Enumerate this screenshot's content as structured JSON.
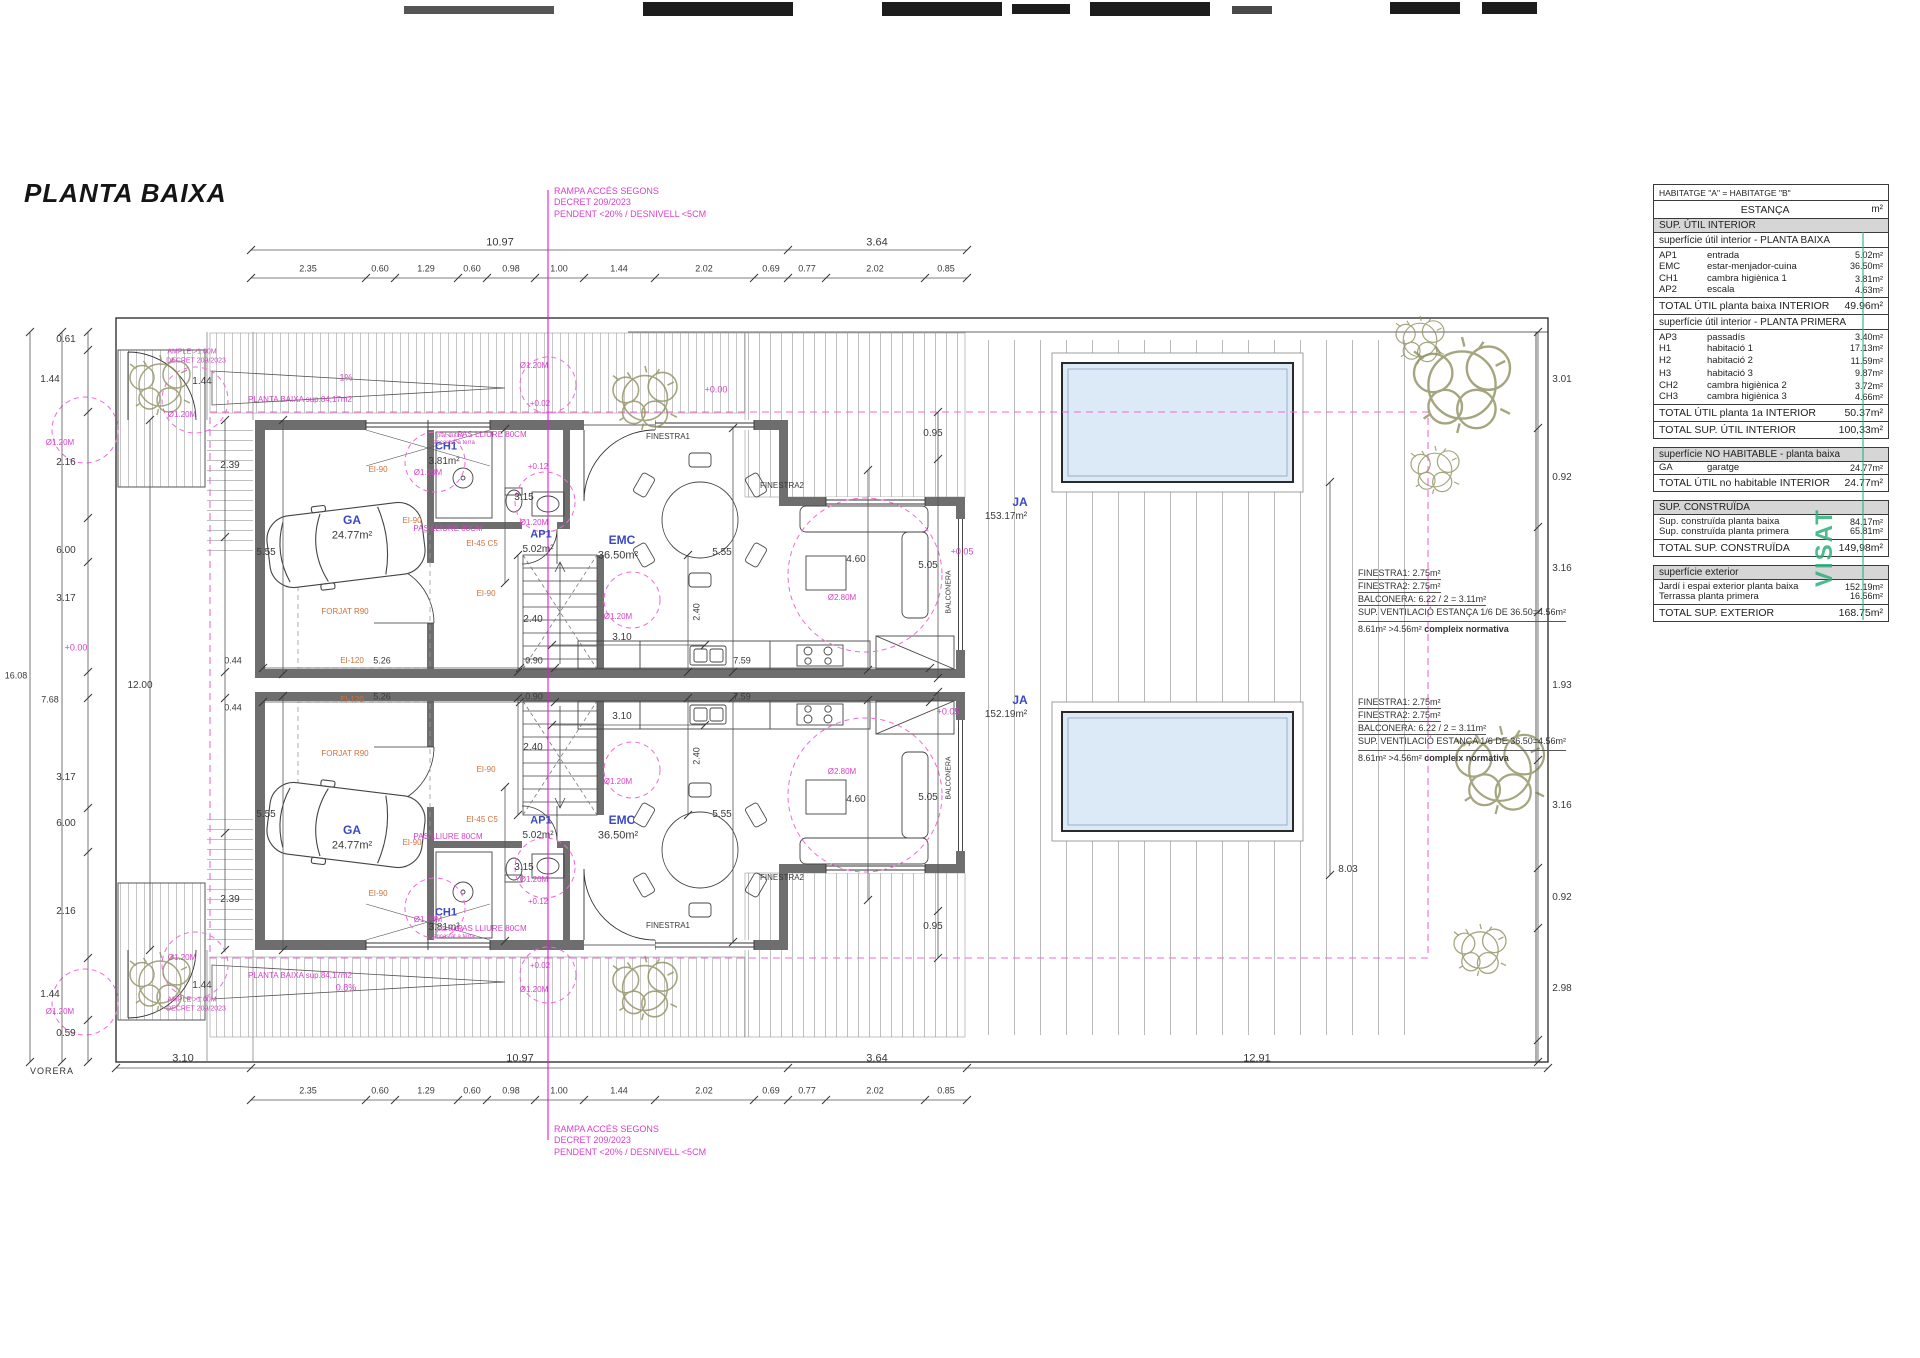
{
  "title": "PLANTA BAIXA",
  "street_label": "VORERA",
  "stamp": {
    "visat": "VISAT"
  },
  "colors": {
    "pink": "#d93fca",
    "orange": "#d2703a",
    "blue": "#3b49c1",
    "pool": "#dce9f6",
    "wall": "#6e6e6e",
    "stamp_green": "#2fae7d"
  },
  "ramp_note": [
    "RAMPA ACCÉS SEGONS",
    "DECRET 209/2023",
    "PENDENT <20% / DESNIVELL <5CM"
  ],
  "vent_note": {
    "lines": [
      "FINESTRA1:  2.75m²",
      "FINESTRA2:  2.75m²",
      "BALCONERA: 6.22 / 2 = 3.11m²"
    ],
    "line4": "SUP. VENTILACIÓ ESTANÇA 1/6 DE 36.50=4.56m²",
    "result": "8.61m² >4.56m² ",
    "result_bold": "compleix normativa"
  },
  "plan_labels": [
    [
      "10.97",
      500,
      243,
      "k",
      11
    ],
    [
      "3.64",
      877,
      243,
      "k",
      11
    ],
    [
      "2.35",
      308,
      269,
      "k",
      9
    ],
    [
      "0.60",
      380,
      269,
      "k",
      9
    ],
    [
      "1.29",
      426,
      269,
      "k",
      9
    ],
    [
      "0.60",
      472,
      269,
      "k",
      9
    ],
    [
      "0.98",
      511,
      269,
      "k",
      9
    ],
    [
      "1.00",
      559,
      269,
      "k",
      9
    ],
    [
      "1.44",
      619,
      269,
      "k",
      9
    ],
    [
      "2.02",
      704,
      269,
      "k",
      9
    ],
    [
      "0.69",
      771,
      269,
      "k",
      9
    ],
    [
      "0.77",
      807,
      269,
      "k",
      9
    ],
    [
      "2.02",
      875,
      269,
      "k",
      9
    ],
    [
      "0.85",
      946,
      269,
      "k",
      9
    ],
    [
      "3.10",
      183,
      1059,
      "k",
      11
    ],
    [
      "10.97",
      520,
      1059,
      "k",
      11
    ],
    [
      "3.64",
      877,
      1059,
      "k",
      11
    ],
    [
      "12.91",
      1257,
      1059,
      "k",
      11
    ],
    [
      "2.35",
      308,
      1091,
      "k",
      9
    ],
    [
      "0.60",
      380,
      1091,
      "k",
      9
    ],
    [
      "1.29",
      426,
      1091,
      "k",
      9
    ],
    [
      "0.60",
      472,
      1091,
      "k",
      9
    ],
    [
      "0.98",
      511,
      1091,
      "k",
      9
    ],
    [
      "1.00",
      559,
      1091,
      "k",
      9
    ],
    [
      "1.44",
      619,
      1091,
      "k",
      9
    ],
    [
      "2.02",
      704,
      1091,
      "k",
      9
    ],
    [
      "0.69",
      771,
      1091,
      "k",
      9
    ],
    [
      "0.77",
      807,
      1091,
      "k",
      9
    ],
    [
      "2.02",
      875,
      1091,
      "k",
      9
    ],
    [
      "0.85",
      946,
      1091,
      "k",
      9
    ],
    [
      "0.61",
      66,
      340,
      "k",
      10
    ],
    [
      "1.44",
      50,
      380,
      "k",
      10
    ],
    [
      "2.16",
      66,
      463,
      "k",
      10
    ],
    [
      "6.00",
      66,
      551,
      "k",
      10
    ],
    [
      "3.17",
      66,
      599,
      "k",
      10
    ],
    [
      "3.17",
      66,
      778,
      "k",
      10
    ],
    [
      "6.00",
      66,
      824,
      "k",
      10
    ],
    [
      "2.16",
      66,
      912,
      "k",
      10
    ],
    [
      "1.44",
      50,
      995,
      "k",
      10
    ],
    [
      "0.59",
      66,
      1034,
      "k",
      10
    ],
    [
      "16.08",
      16,
      676,
      "k",
      9
    ],
    [
      "7.68",
      50,
      700,
      "k",
      9
    ],
    [
      "12.00",
      140,
      686,
      "k",
      10
    ],
    [
      "0.44",
      233,
      661,
      "k",
      9
    ],
    [
      "0.44",
      233,
      708,
      "k",
      9
    ],
    [
      "+0.00",
      76,
      648,
      "p",
      9
    ],
    [
      "3.01",
      1562,
      380,
      "k",
      10
    ],
    [
      "0.92",
      1562,
      478,
      "k",
      10
    ],
    [
      "3.16",
      1562,
      569,
      "k",
      10
    ],
    [
      "1.93",
      1562,
      686,
      "k",
      10
    ],
    [
      "3.16",
      1562,
      806,
      "k",
      10
    ],
    [
      "0.92",
      1562,
      898,
      "k",
      10
    ],
    [
      "2.98",
      1562,
      989,
      "k",
      10
    ],
    [
      "8.03",
      1348,
      870,
      "k",
      10
    ],
    [
      "5.55",
      266,
      553,
      "k",
      10
    ],
    [
      "5.55",
      266,
      815,
      "k",
      10
    ],
    [
      "5.55",
      722,
      553,
      "k",
      10
    ],
    [
      "5.55",
      722,
      815,
      "k",
      10
    ],
    [
      "2.39",
      230,
      466,
      "k",
      10
    ],
    [
      "2.39",
      230,
      900,
      "k",
      10
    ],
    [
      "3.15",
      524,
      498,
      "k",
      10
    ],
    [
      "3.15",
      524,
      868,
      "k",
      10
    ],
    [
      "2.40",
      533,
      620,
      "k",
      10
    ],
    [
      "2.40",
      533,
      748,
      "k",
      10
    ],
    [
      "2.40",
      697,
      612,
      "k",
      9,
      1
    ],
    [
      "2.40",
      697,
      756,
      "k",
      9,
      1
    ],
    [
      "3.10",
      622,
      638,
      "k",
      10
    ],
    [
      "3.10",
      622,
      717,
      "k",
      10
    ],
    [
      "0.90",
      534,
      661,
      "k",
      9
    ],
    [
      "0.90",
      534,
      697,
      "k",
      9
    ],
    [
      "5.26",
      382,
      661,
      "k",
      9
    ],
    [
      "5.26",
      382,
      697,
      "k",
      9
    ],
    [
      "7.59",
      742,
      661,
      "k",
      9
    ],
    [
      "7.59",
      742,
      697,
      "k",
      9
    ],
    [
      "0.95",
      933,
      434,
      "k",
      10
    ],
    [
      "0.95",
      933,
      927,
      "k",
      10
    ],
    [
      "5.05",
      928,
      566,
      "k",
      10
    ],
    [
      "5.05",
      928,
      798,
      "k",
      10
    ],
    [
      "4.60",
      856,
      560,
      "k",
      10
    ],
    [
      "4.60",
      856,
      800,
      "k",
      10
    ],
    [
      "FINESTRA1",
      668,
      437,
      "k",
      8
    ],
    [
      "FINESTRA1",
      668,
      926,
      "k",
      8
    ],
    [
      "FINESTRA2",
      782,
      486,
      "k",
      8
    ],
    [
      "FINESTRA2",
      782,
      878,
      "k",
      8
    ],
    [
      "BALCONERA",
      949,
      592,
      "k",
      7,
      1
    ],
    [
      "BALCONERA",
      949,
      778,
      "k",
      7,
      1
    ],
    [
      "GA",
      352,
      520,
      "b",
      12
    ],
    [
      "24.77m²",
      352,
      536,
      "k",
      11
    ],
    [
      "GA",
      352,
      830,
      "b",
      12
    ],
    [
      "24.77m²",
      352,
      846,
      "k",
      11
    ],
    [
      "CH1",
      446,
      447,
      "b",
      11
    ],
    [
      "3.81m²",
      444,
      462,
      "k",
      10
    ],
    [
      "CH1",
      446,
      913,
      "b",
      11
    ],
    [
      "3.81m²",
      444,
      928,
      "k",
      10
    ],
    [
      "AP1",
      541,
      535,
      "b",
      11
    ],
    [
      "5.02m²",
      538,
      550,
      "k",
      10
    ],
    [
      "AP1",
      541,
      821,
      "b",
      11
    ],
    [
      "5.02m²",
      538,
      836,
      "k",
      10
    ],
    [
      "EMC",
      622,
      540,
      "b",
      12
    ],
    [
      "36.50m²",
      618,
      556,
      "k",
      11
    ],
    [
      "EMC",
      622,
      820,
      "b",
      12
    ],
    [
      "36.50m²",
      618,
      836,
      "k",
      11
    ],
    [
      "JA",
      1020,
      502,
      "b",
      12
    ],
    [
      "153.17m²",
      1006,
      517,
      "k",
      10
    ],
    [
      "JA",
      1020,
      700,
      "b",
      12
    ],
    [
      "152.19m²",
      1006,
      715,
      "k",
      10
    ],
    [
      "EI-90",
      378,
      470,
      "o",
      8
    ],
    [
      "EI-90",
      412,
      521,
      "o",
      8
    ],
    [
      "EI-90",
      486,
      594,
      "o",
      8
    ],
    [
      "EI-90",
      378,
      894,
      "o",
      8
    ],
    [
      "EI-90",
      412,
      843,
      "o",
      8
    ],
    [
      "EI-90",
      486,
      770,
      "o",
      8
    ],
    [
      "EI-45 C5",
      482,
      544,
      "o",
      8
    ],
    [
      "EI-45 C5",
      482,
      820,
      "o",
      8
    ],
    [
      "EI-120",
      352,
      661,
      "o",
      8
    ],
    [
      "EI-120",
      352,
      700,
      "o",
      8
    ],
    [
      "FORJAT R90",
      345,
      612,
      "o",
      8
    ],
    [
      "FORJAT R90",
      345,
      754,
      "o",
      8
    ],
    [
      "PAS LLIURE 80CM",
      492,
      435,
      "p",
      8
    ],
    [
      "PAS LLIURE 80CM",
      448,
      529,
      "p",
      8
    ],
    [
      "PAS LLIURE 80CM",
      492,
      929,
      "p",
      8
    ],
    [
      "PAS LLIURE 80CM",
      448,
      837,
      "p",
      8
    ],
    [
      "Ø1.20M",
      60,
      443,
      "p",
      8
    ],
    [
      "Ø1.20M",
      182,
      415,
      "p",
      8
    ],
    [
      "Ø1.20M",
      534,
      366,
      "p",
      8
    ],
    [
      "Ø1.20M",
      428,
      473,
      "p",
      8
    ],
    [
      "Ø1.20M",
      534,
      523,
      "p",
      8
    ],
    [
      "Ø1.20M",
      618,
      617,
      "p",
      8
    ],
    [
      "Ø1.20M",
      60,
      1012,
      "p",
      8
    ],
    [
      "Ø1.20M",
      182,
      958,
      "p",
      8
    ],
    [
      "Ø1.20M",
      534,
      990,
      "p",
      8
    ],
    [
      "Ø1.20M",
      428,
      920,
      "p",
      8
    ],
    [
      "Ø1.20M",
      534,
      880,
      "p",
      8
    ],
    [
      "Ø1.20M",
      618,
      782,
      "p",
      8
    ],
    [
      "Ø2.80M",
      842,
      598,
      "p",
      8
    ],
    [
      "Ø2.80M",
      842,
      772,
      "p",
      8
    ],
    [
      "+0.00",
      716,
      390,
      "p",
      9
    ],
    [
      "+0.05",
      962,
      552,
      "p",
      9
    ],
    [
      "+0.05",
      948,
      712,
      "p",
      9
    ],
    [
      "+0.12",
      538,
      467,
      "p",
      8
    ],
    [
      "+0.12",
      538,
      902,
      "p",
      8
    ],
    [
      "+0.02",
      540,
      404,
      "p",
      8
    ],
    [
      "+0.02",
      540,
      966,
      "p",
      8
    ],
    [
      "1%",
      346,
      378,
      "p",
      9
    ],
    [
      "0.8%",
      346,
      988,
      "p",
      9
    ],
    [
      "PLANTA BAIXA sup.84,17m2",
      300,
      400,
      "p",
      8
    ],
    [
      "PLANTA BAIXA sup.84,17m2",
      300,
      976,
      "p",
      8
    ],
    [
      "AMPLE >1.00M",
      192,
      352,
      "p",
      7
    ],
    [
      "DECRET 209/2023",
      196,
      361,
      "p",
      7
    ],
    [
      "AMPLE >1.00M",
      192,
      1000,
      "p",
      7
    ],
    [
      "DECRET 209/2023",
      196,
      1009,
      "p",
      7
    ],
    [
      "1.44",
      202,
      382,
      "k",
      10
    ],
    [
      "1.44",
      202,
      986,
      "k",
      10
    ],
    [
      "plat dutxa",
      450,
      436,
      "p",
      6
    ],
    [
      "encastat a terra",
      454,
      443,
      "p",
      6
    ],
    [
      "plat dutxa",
      450,
      930,
      "p",
      6
    ],
    [
      "encastat a terra",
      454,
      937,
      "p",
      6
    ]
  ],
  "tables": [
    {
      "t": "box",
      "c": "HABITATGE \"A\" = HABITATGE \"B\""
    },
    {
      "t": "cols",
      "a": "ESTANÇA",
      "b": "m²"
    },
    {
      "t": "gray",
      "c": "SUP. ÚTIL INTERIOR"
    },
    {
      "t": "sub",
      "c": "superfície útil interior - PLANTA BAIXA"
    },
    {
      "t": "d",
      "a": "AP1",
      "b": "entrada",
      "v": "5.02m²"
    },
    {
      "t": "d",
      "a": "EMC",
      "b": "estar-menjador-cuina",
      "v": "36.50m²"
    },
    {
      "t": "d",
      "a": "CH1",
      "b": "cambra higiènica 1",
      "v": "3.81m²"
    },
    {
      "t": "d",
      "a": "AP2",
      "b": "escala",
      "v": "4.63m²"
    },
    {
      "t": "tot",
      "a": "TOTAL ÚTIL planta baixa INTERIOR",
      "v": "49.96m²"
    },
    {
      "t": "sub",
      "c": "superfície útil interior - PLANTA PRIMERA"
    },
    {
      "t": "d",
      "a": "AP3",
      "b": "passadís",
      "v": "3.40m²"
    },
    {
      "t": "d",
      "a": "H1",
      "b": "habitació 1",
      "v": "17.13m²"
    },
    {
      "t": "d",
      "a": "H2",
      "b": "habitació 2",
      "v": "11.59m²"
    },
    {
      "t": "d",
      "a": "H3",
      "b": "habitació 3",
      "v": "9.87m²"
    },
    {
      "t": "d",
      "a": "CH2",
      "b": "cambra higiènica 2",
      "v": "3.72m²"
    },
    {
      "t": "d",
      "a": "CH3",
      "b": "cambra higiènica 3",
      "v": "4.66m²"
    },
    {
      "t": "tot",
      "a": "TOTAL ÚTIL planta 1a INTERIOR",
      "v": "50.37m²"
    },
    {
      "t": "tot",
      "a": "TOTAL SUP. ÚTIL INTERIOR",
      "v": "100,33m²"
    },
    {
      "t": "gap"
    },
    {
      "t": "gray",
      "c": "superfície NO HABITABLE - planta baixa"
    },
    {
      "t": "d",
      "a": "GA",
      "b": "garatge",
      "v": "24.77m²"
    },
    {
      "t": "tot",
      "a": "TOTAL ÚTIL no habitable INTERIOR",
      "v": "24.77m²"
    },
    {
      "t": "gap"
    },
    {
      "t": "gray",
      "c": "SUP. CONSTRUÏDA"
    },
    {
      "t": "d2",
      "b": "Sup. construïda planta baixa",
      "v": "84.17m²"
    },
    {
      "t": "d2",
      "b": "Sup. construïda planta primera",
      "v": "65.81m²"
    },
    {
      "t": "tot",
      "a": "TOTAL SUP. CONSTRUÏDA",
      "v": "149,98m²"
    },
    {
      "t": "gap"
    },
    {
      "t": "gray",
      "c": "superfície exterior"
    },
    {
      "t": "d2",
      "b": "Jardí i espai exterior planta baixa",
      "v": "152.19m²"
    },
    {
      "t": "d2",
      "b": "Terrassa planta primera",
      "v": "16.56m²"
    },
    {
      "t": "tot",
      "a": "TOTAL SUP. EXTERIOR",
      "v": "168.75m²"
    }
  ]
}
